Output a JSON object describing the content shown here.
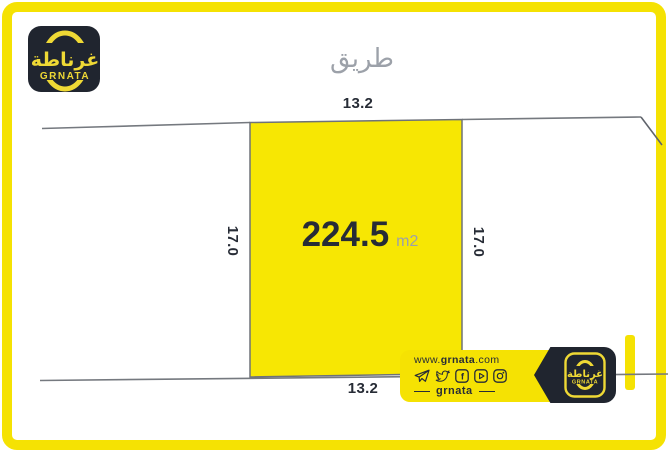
{
  "colors": {
    "yellow": "#F5E203",
    "plot-yellow": "#F7E703",
    "dark": "#20252F",
    "dark-text": "#272C36",
    "gray": "#9CA1A9",
    "line-gray": "#75797F"
  },
  "logo": {
    "arabic": "غرناطة",
    "latin": "GRNATA"
  },
  "road": {
    "label": "طريق"
  },
  "plot": {
    "area_value": "224.5",
    "area_unit": "m2",
    "width_top": "13.2",
    "width_bottom": "13.2",
    "height_left": "17.0",
    "height_right": "17.0"
  },
  "badge": {
    "website": {
      "prefix": "www.",
      "name": "grnata",
      "suffix": ".com"
    },
    "brand": "grnata",
    "social": [
      "telegram",
      "twitter",
      "facebook",
      "youtube",
      "instagram"
    ],
    "logo": {
      "arabic": "غرناطة",
      "latin": "GRNATA"
    }
  }
}
